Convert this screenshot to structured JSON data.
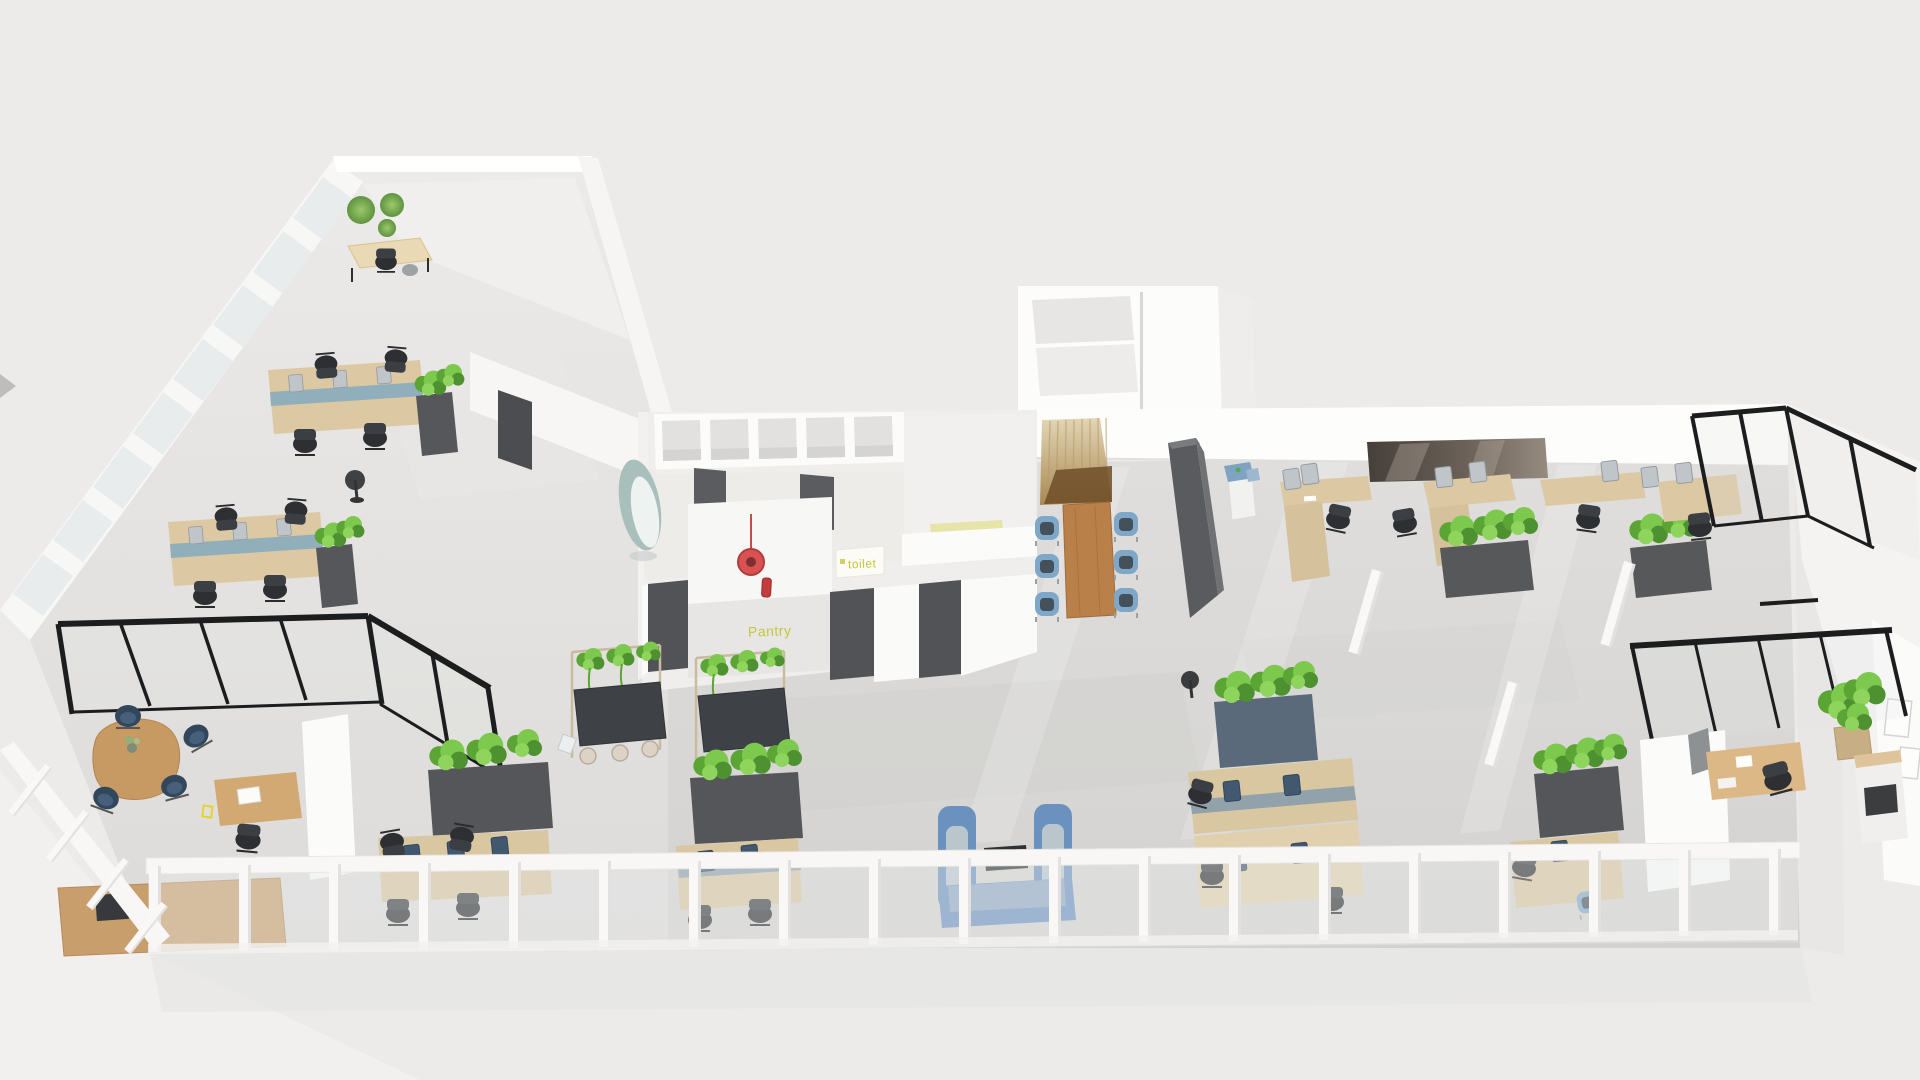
{
  "view": {
    "type": "3d-isometric-office-floorplan-render",
    "background_color": "#ecebe9"
  },
  "labels": {
    "toilet": "toilet",
    "pantry": "Pantry"
  },
  "palette": {
    "background": "#ecebe9",
    "floor_concrete": "#d6d5d3",
    "wall_white": "#fbfbfa",
    "glass_frame_black": "#1c1d1e",
    "wood_light": "#dcc9a4",
    "wood_medium": "#c79a63",
    "wood_conference": "#b9804a",
    "slat_wood": "#c8b387",
    "plant_green": "#6fbe45",
    "planter_gray": "#55575a",
    "chair_black": "#2d2f32",
    "chair_blue": "#7fa8c8",
    "sofa_blue": "#6b92bf",
    "navy_chair": "#32465c",
    "teal_pod": "#a9bfbb",
    "red_accent": "#d85252",
    "floor_label_yellow": "#c6c63d",
    "railing_white": "#f8f7f6"
  },
  "zones": [
    {
      "id": "focus-room-top-left",
      "desc": "small room with three green moss wall circles, light wood table and chairs"
    },
    {
      "id": "window-wall-left",
      "desc": "diagonal band of white-framed glazing along the left facade"
    },
    {
      "id": "workstation-cluster-left-1",
      "desc": "4-seat bench desk, blue dividers, monitors, black task chairs, planter cabinet"
    },
    {
      "id": "workstation-cluster-left-2",
      "desc": "4-seat bench desk, blue dividers, monitors, black task chairs, planter cabinet"
    },
    {
      "id": "glass-meeting-room-left",
      "desc": "black-framed glass room with organic wood table, four navy chairs, desk with laptop, task chair"
    },
    {
      "id": "core-block",
      "desc": "white service core with storage cubbies, toilet rooms with dark doors, pantry recess with red pendant and fire extinguisher",
      "floor_labels": [
        "toilet",
        "Pantry"
      ]
    },
    {
      "id": "privacy-pod",
      "desc": "teal curved acoustic pod chair"
    },
    {
      "id": "storage-room-block-top",
      "desc": "white room volume behind the back wall"
    },
    {
      "id": "meeting-nook",
      "desc": "wood slat feature wall, rectangular wood table, six light-blue chairs"
    },
    {
      "id": "dark-partition",
      "desc": "tall dark gray freestanding partition"
    },
    {
      "id": "copier-station",
      "desc": "white office printer with blue panels"
    },
    {
      "id": "media-wall",
      "desc": "wide dark wall-mounted screen above the right desks"
    },
    {
      "id": "workstation-row-right",
      "desc": "bench desks with monitors, black task chairs, two dark planter cabinets with green plants, white structural columns"
    },
    {
      "id": "glass-corner-right",
      "desc": "black-framed glass partitions at the building corner"
    },
    {
      "id": "executive-office-right",
      "desc": "glass-fronted office with L-shaped desk, black chair, potted plant in basket, wood sideboard, wall art"
    },
    {
      "id": "hanging-plant-table-1",
      "desc": "standing-height dark table with plant frame overhead and stools"
    },
    {
      "id": "hanging-plant-table-2",
      "desc": "standing-height dark table with plant frame overhead and stools"
    },
    {
      "id": "bench-desks-bottom-a",
      "desc": "desk pair with monitors and planter cabinet"
    },
    {
      "id": "bench-desks-bottom-b",
      "desc": "desk pair with monitors and planter cabinet"
    },
    {
      "id": "sofa-booth",
      "desc": "two blue high-back sofas facing over a dark coffee table"
    },
    {
      "id": "bench-desks-bottom-c",
      "desc": "desk group with monitors, planter cabinet and round side stool"
    },
    {
      "id": "bench-desks-bottom-d",
      "desc": "desk group with monitor, planter cabinet and blue chair"
    },
    {
      "id": "terrace-railing",
      "desc": "white balustrade with glass panels along the bottom and lower-left edge, wood bench behind"
    }
  ]
}
